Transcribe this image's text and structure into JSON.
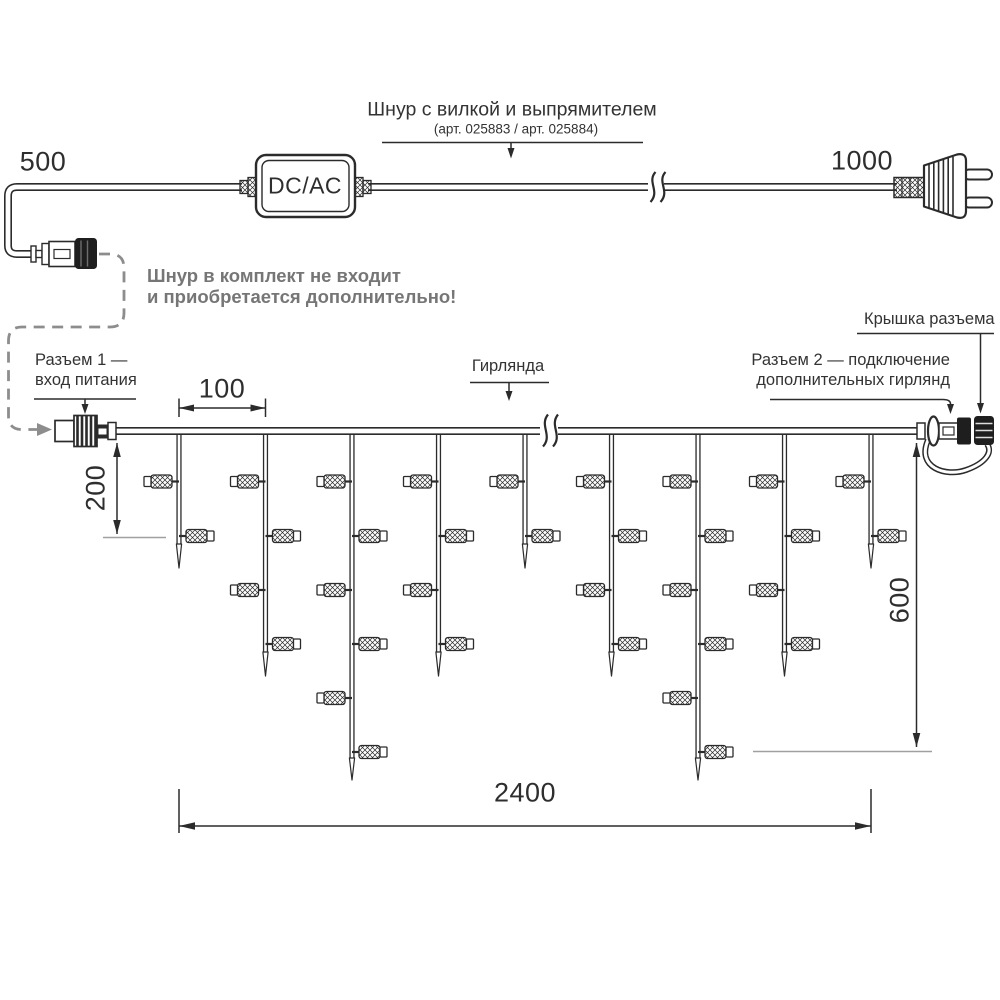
{
  "palette": {
    "ink": "#2b2b2b",
    "gray_text": "#767676",
    "gray_dash": "#8d8d8d",
    "ref_line": "#a0a0a0",
    "background": "#ffffff"
  },
  "cord": {
    "len_left": "500",
    "len_right": "1000",
    "box": "DC/AC",
    "title": "Шнур с вилкой и выпрямителем",
    "article": "(арт. 025883 / арт. 025884)",
    "note1": "Шнур в комплект не входит",
    "note2": "и приобретается дополнительно!"
  },
  "labels": {
    "connector1_line1": "Разъем 1 —",
    "connector1_line2": "вход питания",
    "garland": "Гирлянда",
    "connector2_line1": "Разъем 2 — подключение",
    "connector2_line2": "дополнительных гирлянд",
    "cap": "Крышка разъема"
  },
  "dims": {
    "led_spacing": "100",
    "first_drop": "200",
    "max_drop": "600",
    "total_length": "2400"
  },
  "garland": {
    "wire_y": 431,
    "x_start": 113,
    "x_end": 923,
    "break_x": 548,
    "led_rows": [
      481.5,
      536,
      590,
      644,
      698,
      752
    ],
    "sizes": {
      "short": {
        "bottom": 544,
        "tip": 568,
        "leds": 2
      },
      "medium": {
        "bottom": 652,
        "tip": 676,
        "leds": 4
      },
      "long": {
        "bottom": 758,
        "tip": 780,
        "leds": 6
      }
    },
    "drops": [
      {
        "x": 179,
        "size": "short"
      },
      {
        "x": 265.5,
        "size": "medium"
      },
      {
        "x": 352,
        "size": "long"
      },
      {
        "x": 438.5,
        "size": "medium"
      },
      {
        "x": 525,
        "size": "short"
      },
      {
        "x": 611.5,
        "size": "medium"
      },
      {
        "x": 698,
        "size": "long"
      },
      {
        "x": 784.5,
        "size": "medium"
      },
      {
        "x": 871,
        "size": "short"
      }
    ]
  }
}
